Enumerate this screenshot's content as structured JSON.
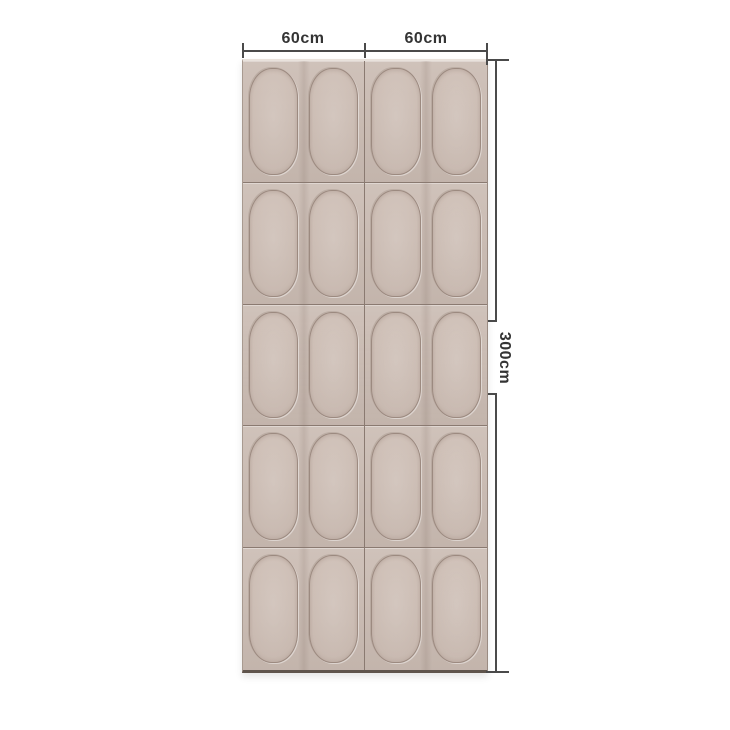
{
  "background": "#ffffff",
  "dimensions": {
    "top": [
      {
        "label": "60cm"
      },
      {
        "label": "60cm"
      }
    ],
    "right": {
      "label": "300cm"
    }
  },
  "panel": {
    "rows": 5,
    "columns": 2,
    "arches_per_tile": 2,
    "colors": {
      "base": "#cabbb2",
      "groove": "#9c8a80",
      "seam": "#8a7a71",
      "bottom_edge": "#5f544c",
      "top_highlight": "#e9e2dc"
    }
  },
  "annotation": {
    "line_color": "#4a4a4a",
    "text_color": "#343434"
  }
}
